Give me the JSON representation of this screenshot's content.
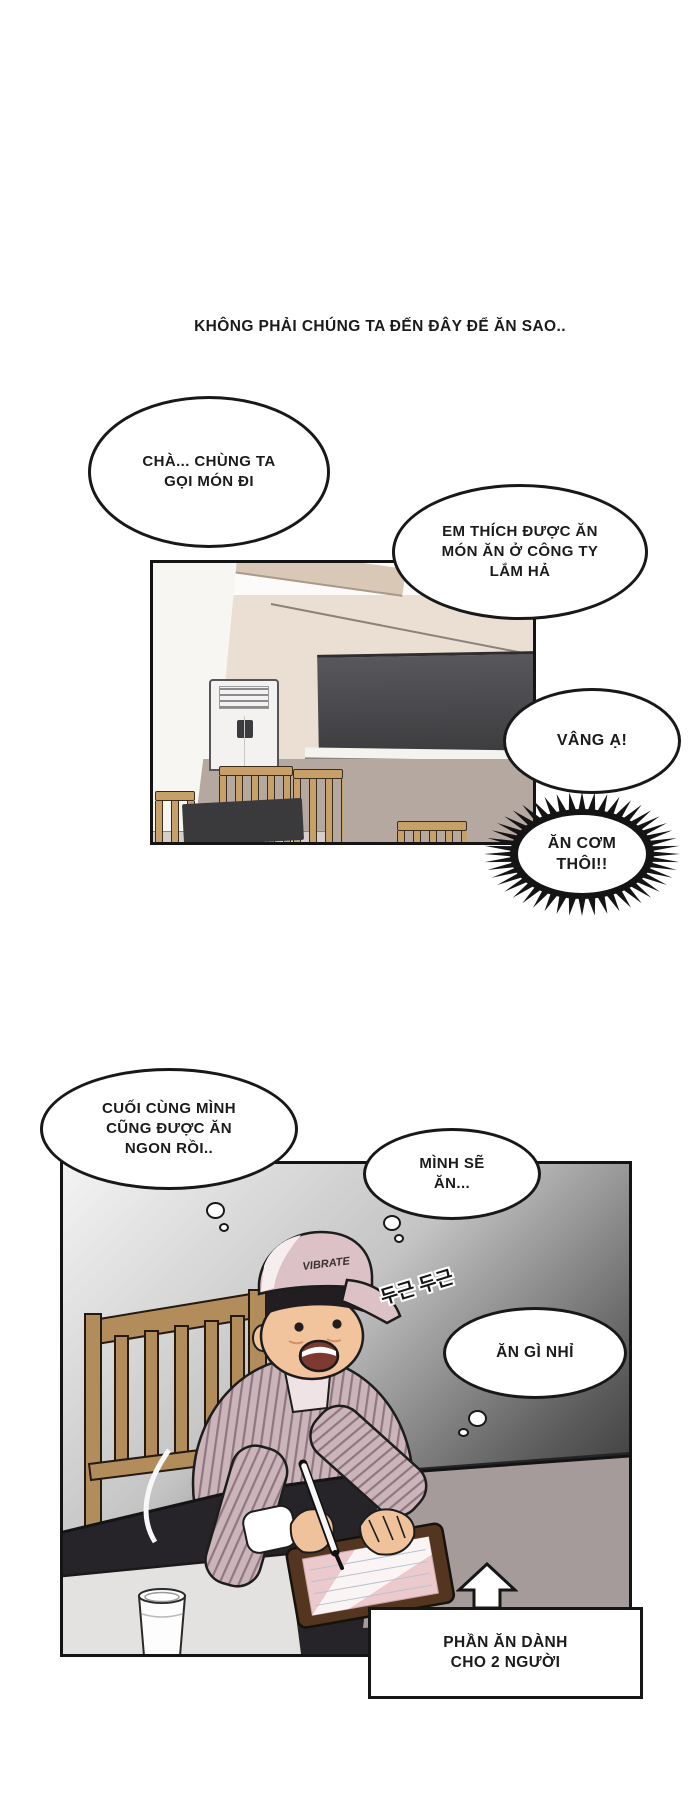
{
  "narration": "KHÔNG PHẢI CHÚNG TA ĐẾN ĐÂY ĐỂ ĂN SAO..",
  "bubbles": {
    "order": {
      "lines": [
        "CHÀ... CHÙNG TA",
        "GỌI MÓN ĐI"
      ]
    },
    "company_food": {
      "lines": [
        "EM THÍCH ĐƯỢC ĂN",
        "MÓN ĂN Ở CÔNG TY",
        "LẮM HẢ"
      ]
    },
    "yes_sir": {
      "lines": [
        "VÂNG Ạ!"
      ]
    },
    "lets_eat": {
      "lines": [
        "ĂN CƠM",
        "THÔI!!"
      ]
    },
    "finally_eat_well": {
      "lines": [
        "CUỐI CÙNG MÌNH",
        "CŨNG ĐƯỢC ĂN",
        "NGON RỒI.."
      ]
    },
    "i_will_eat": {
      "lines": [
        "MÌNH SẼ",
        "ĂN..."
      ]
    },
    "what_to_eat": {
      "lines": [
        "ĂN GÌ NHỈ"
      ]
    }
  },
  "sfx": {
    "heartbeat": "두근 두근"
  },
  "props": {
    "cap_logo": "VIBRATE"
  },
  "caption": {
    "lines": [
      "PHẦN ĂN DÀNH",
      "CHO 2 NGƯỜI"
    ]
  },
  "colors": {
    "ink": "#1b1b1b",
    "bubble_fill": "#ffffff",
    "wall_cream": "#eadfd2",
    "wall_mauve": "#b5a8a0",
    "menu_board_dark": "#46464a",
    "wood_chair": "#c79f68",
    "cap_pink": "#dcc1c6",
    "shirt_pink": "#ccb5ba",
    "table_dark": "#262429",
    "tabletop_light": "#e4e2e0"
  }
}
